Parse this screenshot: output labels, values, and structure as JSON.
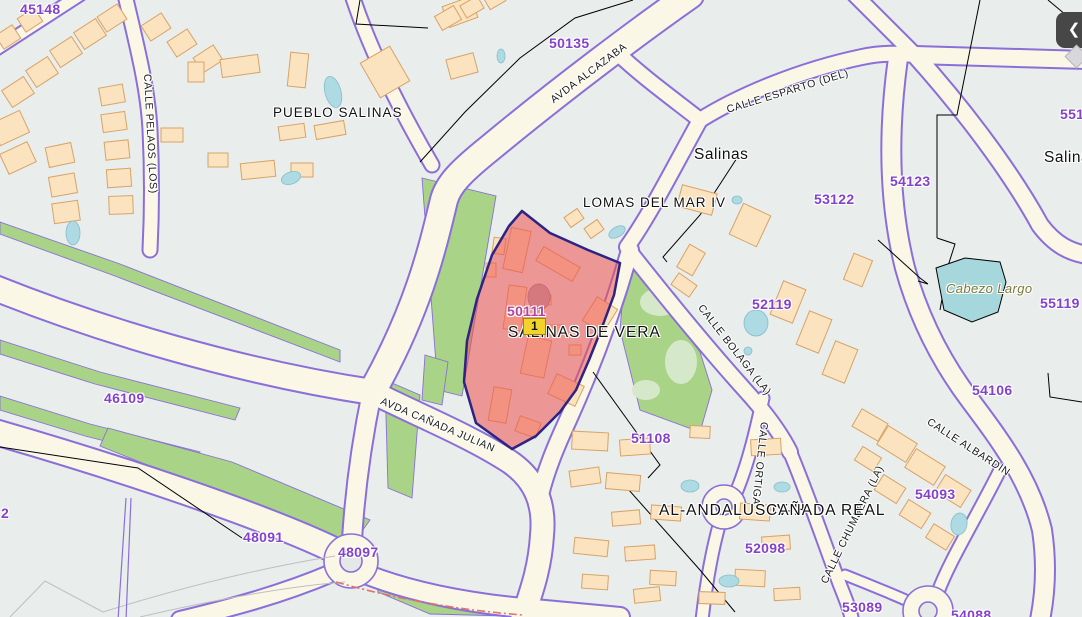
{
  "map": {
    "selected_parcel": {
      "code": "50111",
      "marker_label": "1"
    },
    "colors": {
      "background": "#E9EDEC",
      "road_fill": "#FAF7E7",
      "road_casing": "#8A6FD9",
      "building": "#FAE3BE",
      "green": "#A9D386",
      "water": "#AEDAE3",
      "highlight_fill": "#EE5050",
      "highlight_border": "#2D2384",
      "parcel_label": "#8442CB",
      "selected_label": "#B0459C",
      "marker_yellow": "#F2D32B",
      "boundary_red_dash": "#E2736B"
    },
    "icons": {
      "back_button": "chevron-left-icon",
      "marker": "parcel-marker"
    }
  },
  "parcel_labels": [
    {
      "text": "45148"
    },
    {
      "text": "50135"
    },
    {
      "text": "54123"
    },
    {
      "text": "53122"
    },
    {
      "text": "551"
    },
    {
      "text": "55119"
    },
    {
      "text": "52119"
    },
    {
      "text": "54106"
    },
    {
      "text": "46109"
    },
    {
      "text": "50111"
    },
    {
      "text": "51108"
    },
    {
      "text": "54093"
    },
    {
      "text": "52098"
    },
    {
      "text": "48091"
    },
    {
      "text": "48097"
    },
    {
      "text": "53089"
    },
    {
      "text": "54088"
    },
    {
      "text": "2"
    }
  ],
  "street_labels": [
    {
      "text": "CALLE PELAOS (LOS)"
    },
    {
      "text": "AVDA ALCAZABA"
    },
    {
      "text": "CALLE ESPARTO (DEL)"
    },
    {
      "text": "CALLE BOLAGA (LA)"
    },
    {
      "text": "CALLE ORTIGA"
    },
    {
      "text": "CALLE ALBARDIN"
    },
    {
      "text": "CALLE CHUMBERA (LA)"
    },
    {
      "text": "AVDA CAÑADA JULIAN"
    }
  ],
  "place_labels": [
    {
      "text": "PUEBLO SALINAS"
    },
    {
      "text": "Salinas"
    },
    {
      "text": "LOMAS DEL MAR IV"
    },
    {
      "text": "SALINAS DE VERA"
    },
    {
      "text": "AL-ANDALUS IV-H"
    },
    {
      "text": "CAÑADA REAL"
    },
    {
      "text": "Salinas"
    },
    {
      "text": "Cabezo Largo"
    }
  ],
  "back_label": "❮"
}
